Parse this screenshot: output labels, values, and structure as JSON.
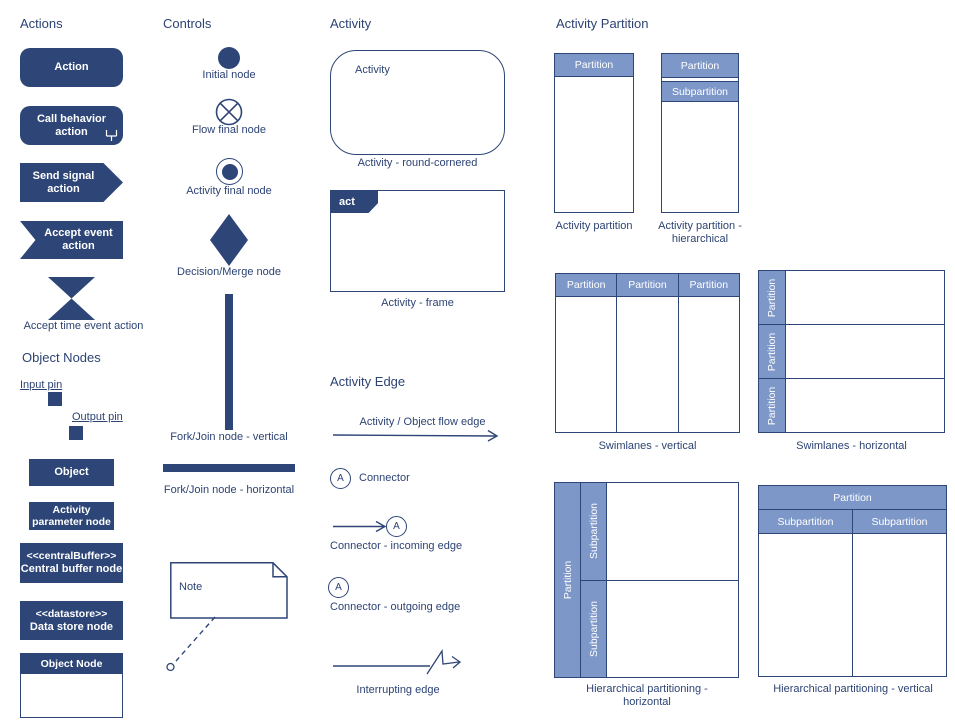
{
  "headings": {
    "actions": "Actions",
    "object_nodes": "Object Nodes",
    "controls": "Controls",
    "activity": "Activity",
    "activity_edge": "Activity Edge",
    "activity_partition": "Activity Partition"
  },
  "actions": {
    "action": "Action",
    "call_behavior": "Call behavior action",
    "send_signal": "Send signal action",
    "accept_event": "Accept event action",
    "accept_time_event": "Accept time event action"
  },
  "object_nodes": {
    "input_pin": "Input pin",
    "output_pin": "Output pin",
    "object": "Object",
    "activity_parameter": "Activity parameter node",
    "central_buffer_stereotype": "<<centralBuffer>>",
    "central_buffer": "Central buffer node",
    "datastore_stereotype": "<<datastore>>",
    "datastore": "Data store node",
    "object_node": "Object Node"
  },
  "controls": {
    "initial_node": "Initial node",
    "flow_final_node": "Flow final node",
    "activity_final_node": "Activity final node",
    "decision_merge_node": "Decision/Merge node",
    "fork_join_vertical": "Fork/Join node - vertical",
    "fork_join_horizontal": "Fork/Join node - horizontal",
    "note": "Note"
  },
  "activity": {
    "activity_label": "Activity",
    "round_cornered_caption": "Activity - round-cornered",
    "frame_tab": "act",
    "frame_caption": "Activity - frame"
  },
  "activity_edge": {
    "flow_edge_caption": "Activity / Object flow edge",
    "connector_letter": "A",
    "connector_caption": "Connector",
    "incoming_caption": "Connector - incoming edge",
    "outgoing_caption": "Connector - outgoing edge",
    "interrupting_caption": "Interrupting edge"
  },
  "partitions": {
    "partition": "Partition",
    "subpartition": "Subpartition",
    "activity_partition_caption": "Activity partition",
    "hierarchical_caption": "Activity partition - hierarchical",
    "swimlanes_vertical_caption": "Swimlanes - vertical",
    "swimlanes_horizontal_caption": "Swimlanes - horizontal",
    "hierarchical_horizontal_caption": "Hierarchical partitioning - horizontal",
    "hierarchical_vertical_caption": "Hierarchical partitioning - vertical"
  },
  "colors": {
    "navy": "#2e4677",
    "header_blue": "#7d97c8",
    "label_text": "#2d4374",
    "shape_text": "#ffffff"
  }
}
